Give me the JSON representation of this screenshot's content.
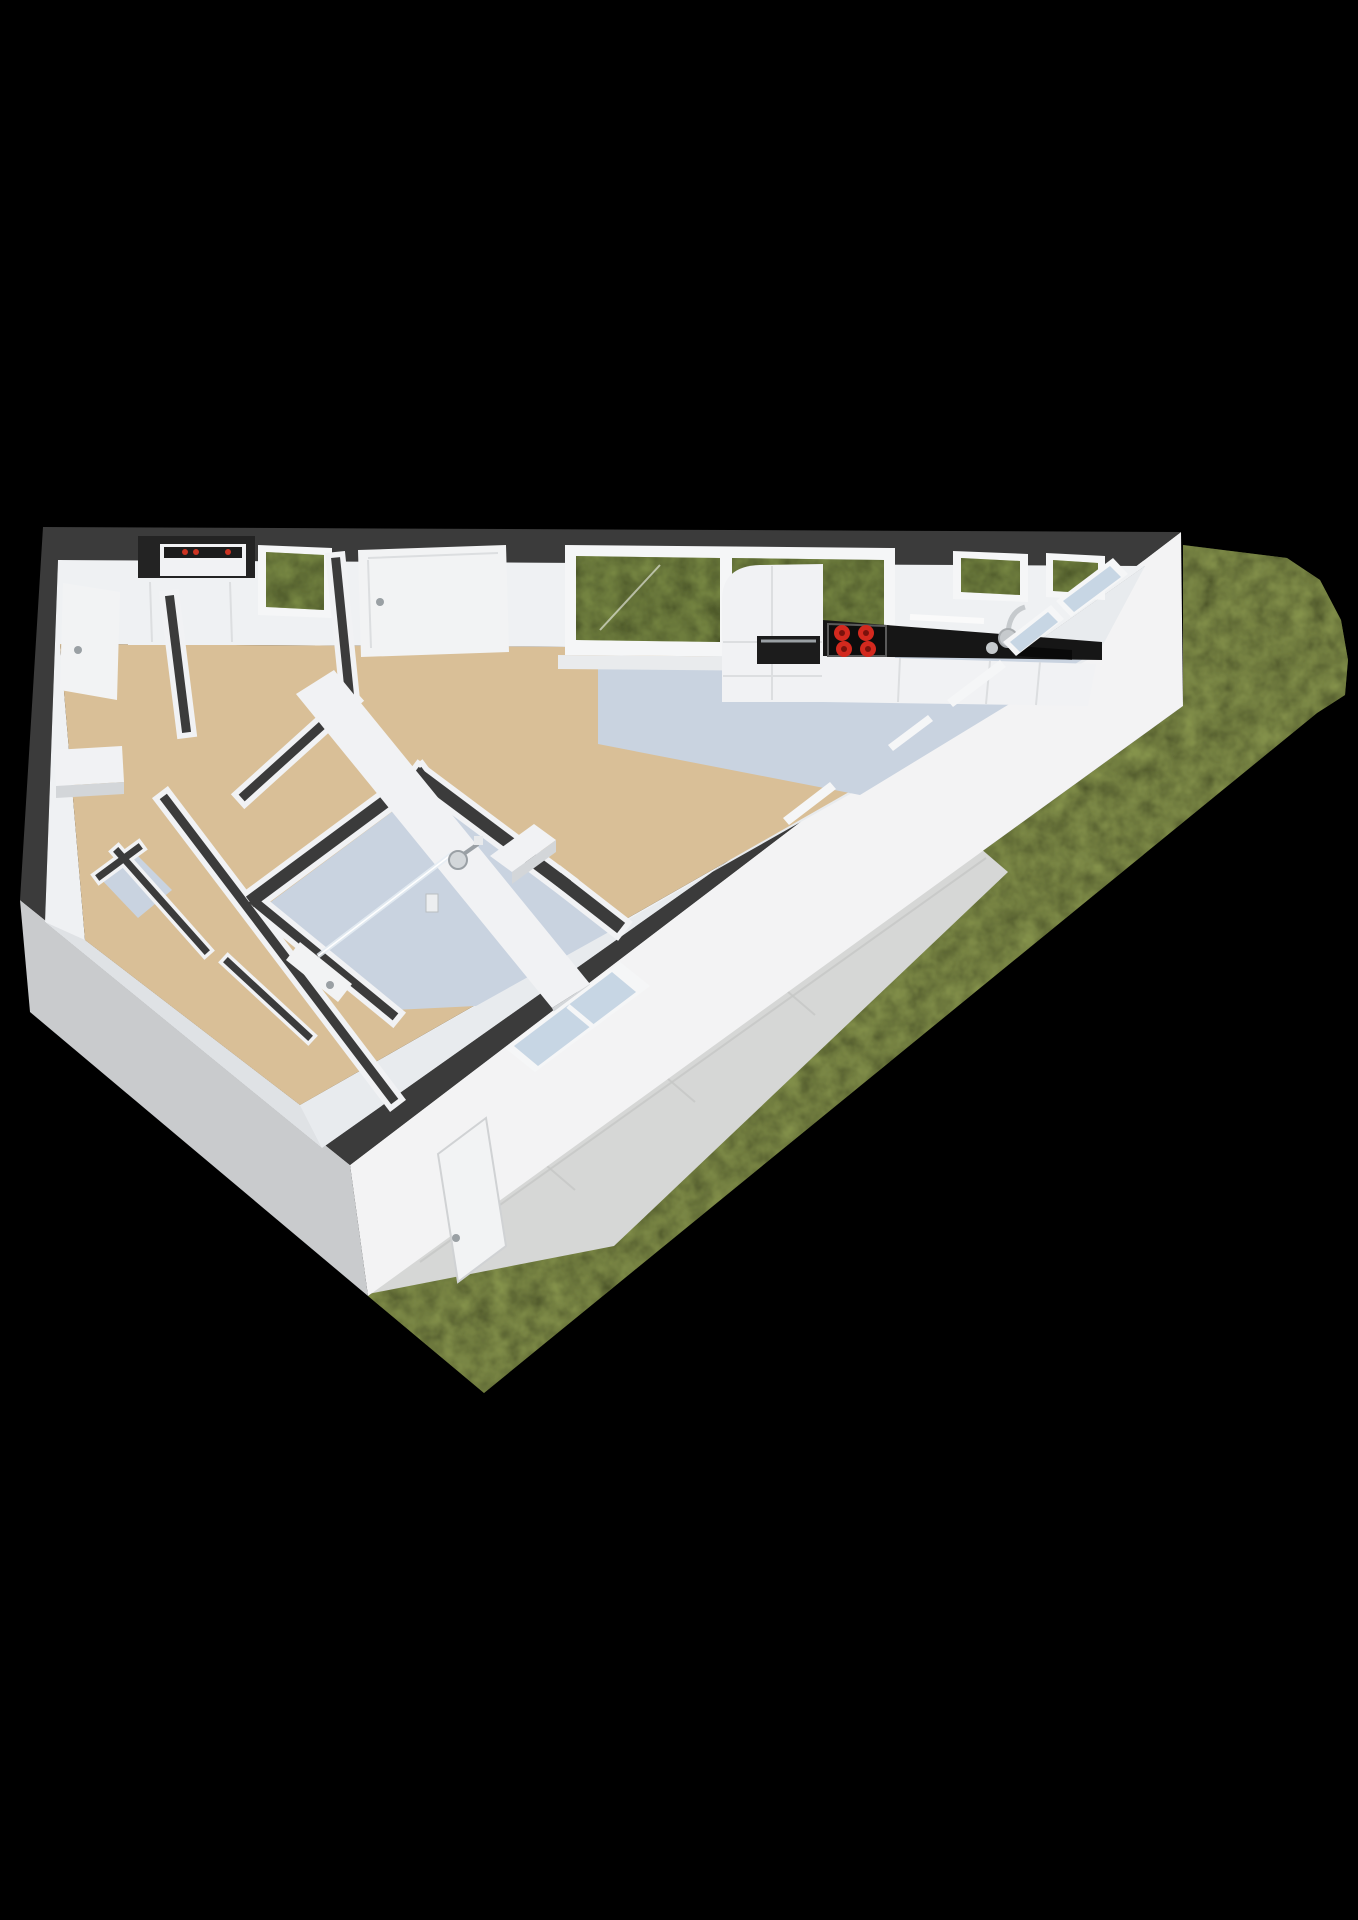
{
  "scene": {
    "kind": "3d-floorplan-render",
    "view": "axonometric-top-down",
    "description": "Rendered 3D floor plan of a small apartment on a black background, with a triangular garden lawn and tiled terrace outside the angled facade"
  },
  "colors": {
    "background": "#000000",
    "wall_top": "#3b3b3b",
    "wall_face_light": "#f3f3f4",
    "wall_face_shade": "#c9cbcd",
    "interior_face": "#eff1f3",
    "interior_face_shade": "#dfe2e5",
    "wall_white": "#f1f2f4",
    "floor_warm": "#d9bf97",
    "floor_cool": "#c9d3e0",
    "grass": "#93a254",
    "glass_green": "#86984c",
    "glass_blue": "#c7d6e4",
    "terrace": "#d6d7d6",
    "frame_white": "#f5f6f7",
    "door_white": "#f2f3f4",
    "counter_black": "#161616",
    "burner_red": "#d3291e",
    "appliance_dark": "#1c1c1c",
    "accent_red": "#cc3322",
    "chrome": "#c6cacd",
    "niche_dark": "#232323",
    "furniture_side": "#d3d6d9",
    "sill_white": "#e9ebed",
    "handle_gray": "#9aa0a4"
  },
  "rooms": [
    {
      "name": "hallway",
      "floor": "warm"
    },
    {
      "name": "meter-closet",
      "floor": "none"
    },
    {
      "name": "bedroom",
      "floor": "warm"
    },
    {
      "name": "living-room",
      "floor": "warm"
    },
    {
      "name": "kitchen",
      "floor": "cool"
    },
    {
      "name": "bathroom",
      "floor": "cool"
    },
    {
      "name": "toilet",
      "floor": "cool"
    }
  ],
  "exterior": {
    "garden": "lawn",
    "terrace": "tiled-patio"
  },
  "kitchen": {
    "burners": 4,
    "appliances": [
      "oven",
      "cooktop",
      "sink"
    ]
  },
  "bathroom": {
    "fixtures": [
      "walk-in-shower",
      "glass-screen",
      "duct-column"
    ]
  }
}
